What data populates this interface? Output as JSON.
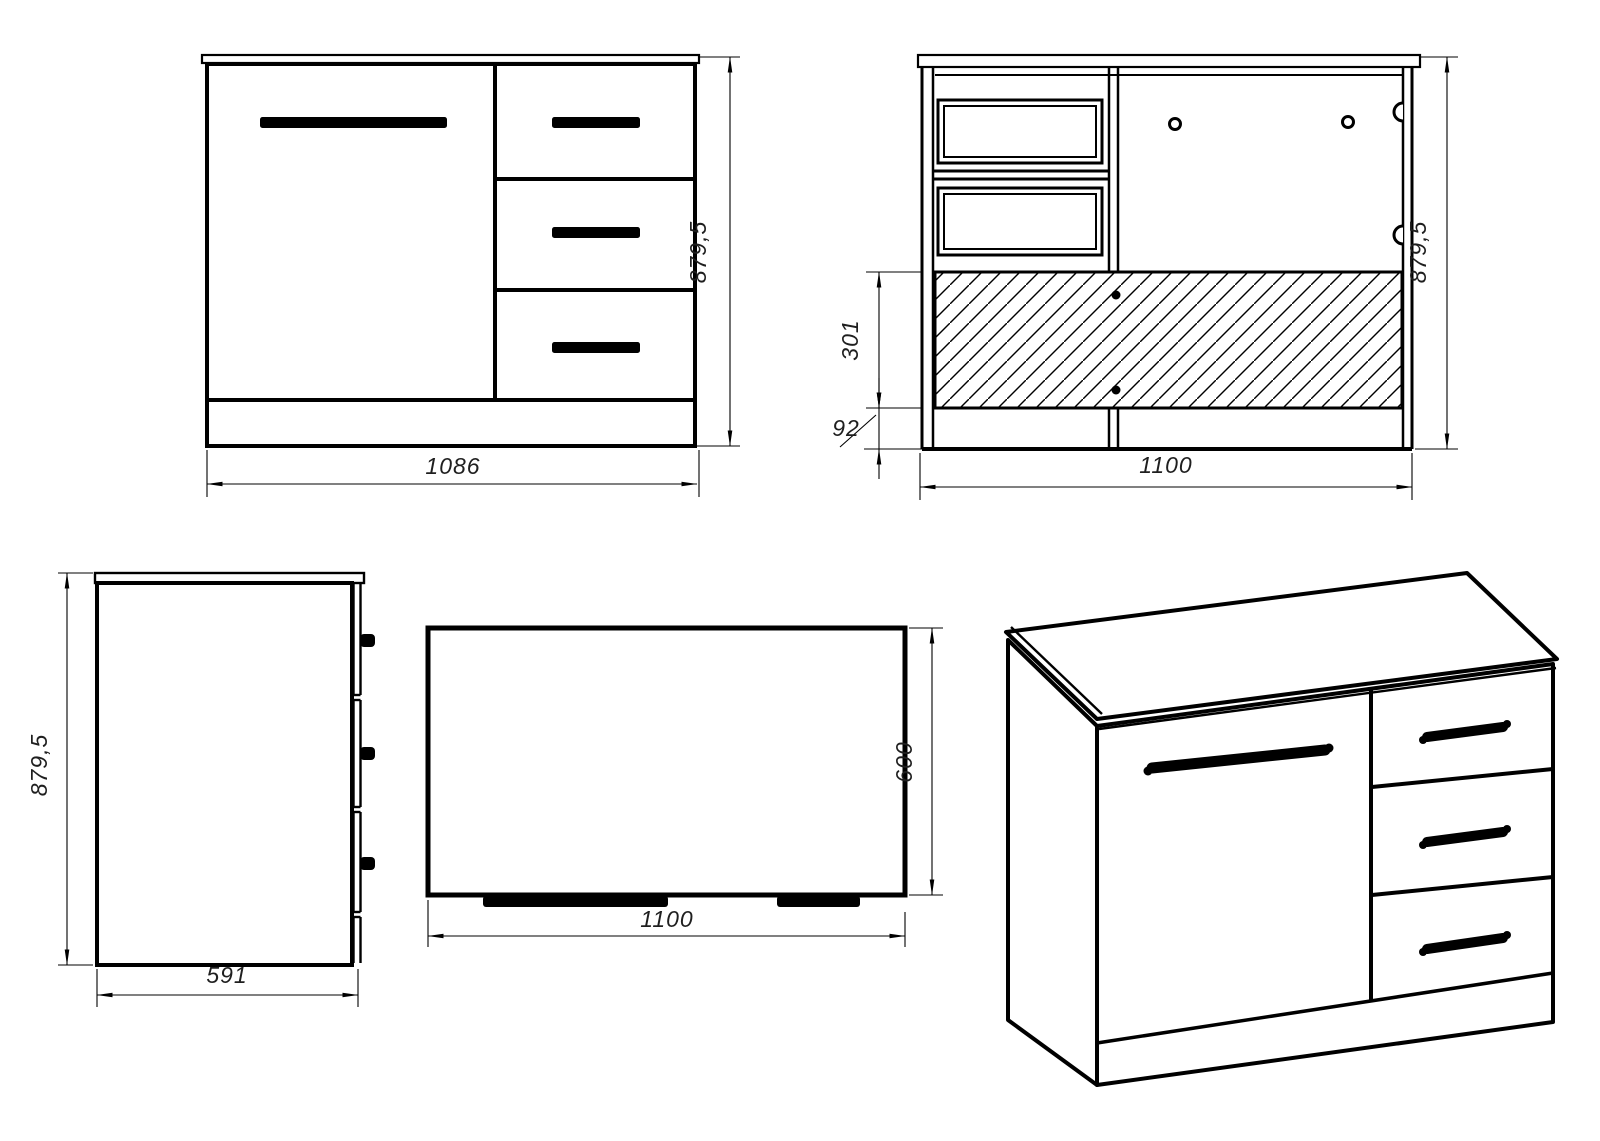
{
  "colors": {
    "line": "#000000",
    "background": "#ffffff",
    "dim_text": "#1f1f1f"
  },
  "views": {
    "front": {
      "width": "1086",
      "height": "879,5"
    },
    "back": {
      "width": "1100",
      "height": "879,5",
      "back_panel_height": "301",
      "plinth_height": "92"
    },
    "side": {
      "depth": "591",
      "height": "879,5"
    },
    "top": {
      "width": "1100",
      "depth": "600"
    }
  }
}
